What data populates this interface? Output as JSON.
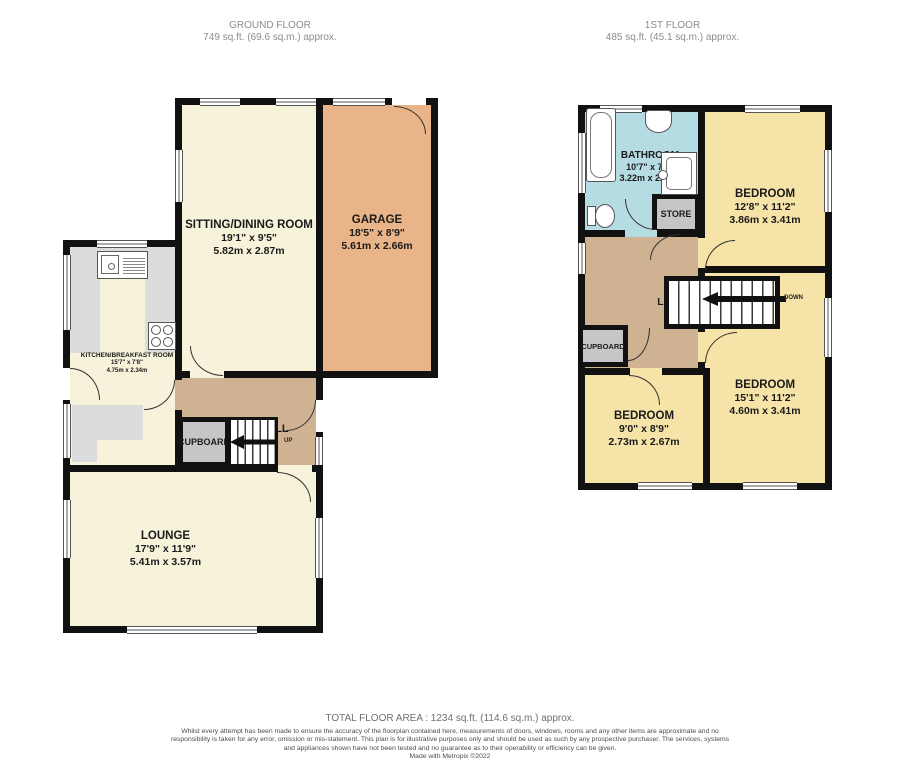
{
  "floors": {
    "ground": {
      "title": "GROUND FLOOR",
      "area": "749 sq.ft. (69.6 sq.m.) approx."
    },
    "first": {
      "title": "1ST FLOOR",
      "area": "485 sq.ft. (45.1 sq.m.) approx."
    }
  },
  "rooms": {
    "sitting_dining": {
      "name": "SITTING/DINING ROOM",
      "imperial": "19'1\"  x 9'5\"",
      "metric": "5.82m  x 2.87m"
    },
    "garage": {
      "name": "GARAGE",
      "imperial": "18'5\"  x 8'9\"",
      "metric": "5.61m  x 2.66m"
    },
    "kitchen": {
      "name": "KITCHEN/BREAKFAST ROOM",
      "imperial": "15'7\"  x 7'8\"",
      "metric": "4.75m  x 2.34m"
    },
    "hall": {
      "name": "HALL"
    },
    "cupboard_ground": {
      "name": "CUPBOARD"
    },
    "lounge": {
      "name": "LOUNGE",
      "imperial": "17'9\"  x 11'9\"",
      "metric": "5.41m  x 3.57m"
    },
    "bathroom": {
      "name": "BATHROOM",
      "imperial": "10'7\"  x 7'9\"",
      "metric": "3.22m  x 2.36m"
    },
    "store": {
      "name": "STORE"
    },
    "bedroom_front": {
      "name": "BEDROOM",
      "imperial": "12'8\"  x 11'2\"",
      "metric": "3.86m  x 3.41m"
    },
    "landing": {
      "name": "LANDING"
    },
    "cupboard_first": {
      "name": "CUPBOARD"
    },
    "bedroom_small": {
      "name": "BEDROOM",
      "imperial": "9'0\"  x 8'9\"",
      "metric": "2.73m  x 2.67m"
    },
    "bedroom_rear": {
      "name": "BEDROOM",
      "imperial": "15'1\"  x 11'2\"",
      "metric": "4.60m  x 3.41m"
    }
  },
  "stairs": {
    "up_label": "UP",
    "down_label": "DOWN"
  },
  "footer": {
    "total_area": "TOTAL FLOOR AREA : 1234 sq.ft. (114.6 sq.m.) approx.",
    "disclaimer": "Whilst every attempt has been made to ensure the accuracy of the floorplan contained here, measurements of doors, windows, rooms and any other items are approximate and no responsibility is taken for any error, omission or mis-statement. This plan is for illustrative purposes only and should be used as such by any prospective purchaser. The services, systems and appliances shown have not been tested and no guarantee as to their operability or efficiency can be given.",
    "credit": "Made with Metropix ©2022"
  },
  "fixtures": {
    "bathtub": "bathtub",
    "wash_basin": "wash-basin",
    "shower": "shower",
    "toilet": "toilet",
    "kitchen_sink": "kitchen-sink",
    "hob": "hob"
  },
  "colors": {
    "room_cream": "#f7f2da",
    "garage_orange": "#e9b487",
    "hall_tan": "#cfb291",
    "bathroom_blue": "#b5dce2",
    "bedroom_yellow": "#f6e3a8",
    "storage_gray": "#c6c6c6",
    "kitchen_counter_gray": "#dcdcdc",
    "wall_black": "#111111"
  }
}
